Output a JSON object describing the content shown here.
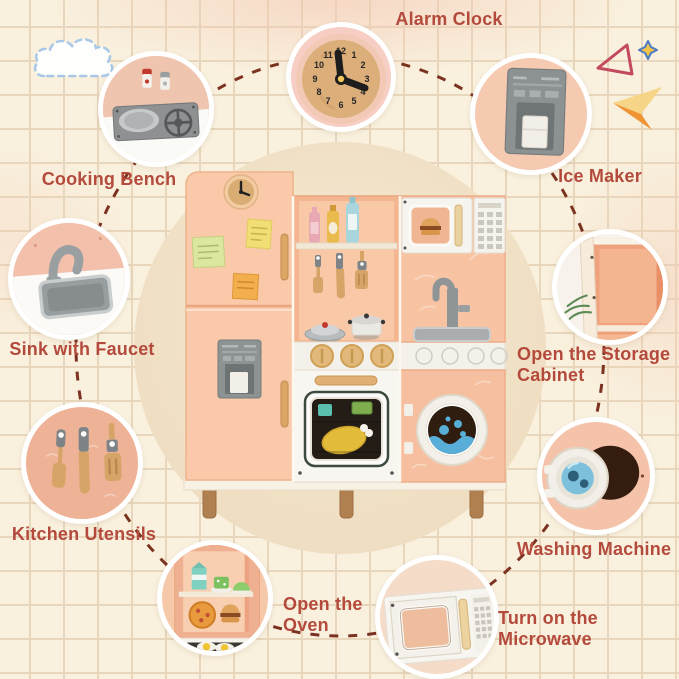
{
  "features": [
    {
      "id": "alarm-clock",
      "label": "Alarm Clock"
    },
    {
      "id": "cooking-bench",
      "label": "Cooking Bench"
    },
    {
      "id": "ice-maker",
      "label": "Ice Maker"
    },
    {
      "id": "sink-with-faucet",
      "label": "Sink with Faucet"
    },
    {
      "id": "storage-cabinet",
      "label": "Open the Storage Cabinet",
      "lines": [
        "Open the Storage",
        "Cabinet"
      ]
    },
    {
      "id": "kitchen-utensils",
      "label": "Kitchen Utensils"
    },
    {
      "id": "washing-machine",
      "label": "Washing Machine"
    },
    {
      "id": "open-oven",
      "label": "Open the Oven",
      "lines": [
        "Open the",
        "Oven"
      ]
    },
    {
      "id": "turn-on-microwave",
      "label": "Turn on the Microwave",
      "lines": [
        "Turn on the",
        "Microwave"
      ]
    }
  ],
  "alarm_clock_numbers": [
    "12",
    "1",
    "2",
    "3",
    "4",
    "5",
    "6",
    "7",
    "8",
    "9",
    "10",
    "11"
  ],
  "decorations": [
    {
      "name": "cloud-doodle"
    },
    {
      "name": "triangle-outline"
    },
    {
      "name": "sparkle"
    },
    {
      "name": "paper-plane"
    }
  ],
  "colors": {
    "background": "#f9f1de",
    "grid_line": "#e8d7bc",
    "label_text": "#b44a3c",
    "dashed_line": "#7c3220",
    "center_circle": "#f2e3c9",
    "bubble_border": "#ffffff",
    "kitchen_body": "#f8c7a6"
  }
}
